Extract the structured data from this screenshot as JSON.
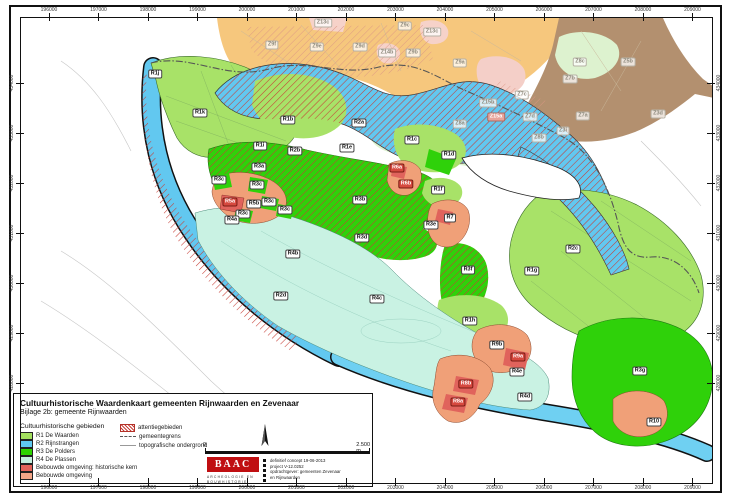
{
  "doc": {
    "title": "Cultuurhistorische Waardenkaart gemeenten Rijnwaarden en Zevenaar",
    "subtitle": "Bijlage 2b: gemeente Rijnwaarden"
  },
  "axes": {
    "x": [
      "196000",
      "197000",
      "198000",
      "199000",
      "200000",
      "201000",
      "202000",
      "203000",
      "204000",
      "205000",
      "206000",
      "207000",
      "208000",
      "209000"
    ],
    "y": [
      "434000",
      "433000",
      "432000",
      "431000",
      "430000",
      "429000",
      "428000"
    ]
  },
  "legend": {
    "areas_header": "Cultuurhistorische gebieden",
    "areas": [
      {
        "label": "R1 De Waarden",
        "color": "#a3e05f"
      },
      {
        "label": "R2 Rijnstrangen",
        "color": "#5fc8f0"
      },
      {
        "label": "R3 De Polders",
        "color": "#2ed400"
      },
      {
        "label": "R4 De Plassen",
        "color": "#c5f0df"
      },
      {
        "label": "Bebouwde omgeving: historische kern",
        "color": "#e4635a"
      },
      {
        "label": "Bebouwde omgeving",
        "color": "#f4a687"
      }
    ],
    "symbols": [
      {
        "label": "attentiegebieden",
        "type": "hatch"
      },
      {
        "label": "gemeentegrens",
        "type": "dashdot"
      },
      {
        "label": "topografische ondergrond",
        "type": "line"
      }
    ]
  },
  "scalebar": {
    "zero": "0",
    "max": "2.500 m"
  },
  "logo": {
    "name": "BAAC",
    "tagline1": "ARCHEOLOGIE EN",
    "tagline2": "BOUWHISTORIE"
  },
  "colophon": {
    "lines": [
      "definitief concept 19-06-2013",
      "project V-12.0252",
      "opdrachtgever: gemeenten Zevenaar",
      "en Rijnwaarden"
    ]
  },
  "colors": {
    "r1": "#a8e268",
    "r2": "#62c8f0",
    "r3": "#2fd10a",
    "r4": "#c9f2e3",
    "kern": "#e0635c",
    "bebouwd": "#f0a078",
    "attention": "#c63d35",
    "zevenaar_orange": "#f6c77d",
    "zevenaar_brown": "#b3906f",
    "zevenaar_pink": "#f6d2c9",
    "zevenaar_green": "#ddf2cf"
  },
  "map_labels": [
    {
      "t": "R1j",
      "x": 155,
      "y": 74,
      "k": "zone"
    },
    {
      "t": "R1k",
      "x": 200,
      "y": 113,
      "k": "zone"
    },
    {
      "t": "R1b",
      "x": 288,
      "y": 120,
      "k": "zone"
    },
    {
      "t": "R2a",
      "x": 359,
      "y": 123,
      "k": "zone"
    },
    {
      "t": "R1i",
      "x": 260,
      "y": 146,
      "k": "zone"
    },
    {
      "t": "R2b",
      "x": 295,
      "y": 151,
      "k": "zone"
    },
    {
      "t": "R1e",
      "x": 347,
      "y": 148,
      "k": "zone"
    },
    {
      "t": "R1c",
      "x": 412,
      "y": 140,
      "k": "zone"
    },
    {
      "t": "R1d",
      "x": 449,
      "y": 155,
      "k": "zone"
    },
    {
      "t": "R1f",
      "x": 438,
      "y": 190,
      "k": "zone"
    },
    {
      "t": "R3a",
      "x": 259,
      "y": 167,
      "k": "zone"
    },
    {
      "t": "R3c",
      "x": 219,
      "y": 180,
      "k": "zone"
    },
    {
      "t": "R3c",
      "x": 257,
      "y": 185,
      "k": "zone"
    },
    {
      "t": "R3b",
      "x": 360,
      "y": 200,
      "k": "zone"
    },
    {
      "t": "R3c",
      "x": 269,
      "y": 202,
      "k": "zone"
    },
    {
      "t": "R5b",
      "x": 254,
      "y": 204,
      "k": "zone"
    },
    {
      "t": "R3c",
      "x": 285,
      "y": 210,
      "k": "zone"
    },
    {
      "t": "R3c",
      "x": 243,
      "y": 214,
      "k": "zone"
    },
    {
      "t": "R4a",
      "x": 232,
      "y": 220,
      "k": "zone"
    },
    {
      "t": "R7",
      "x": 450,
      "y": 218,
      "k": "zone"
    },
    {
      "t": "R3e",
      "x": 431,
      "y": 225,
      "k": "zone"
    },
    {
      "t": "R3d",
      "x": 362,
      "y": 238,
      "k": "zone"
    },
    {
      "t": "R2c",
      "x": 573,
      "y": 249,
      "k": "zone"
    },
    {
      "t": "R4b",
      "x": 293,
      "y": 254,
      "k": "zone"
    },
    {
      "t": "R3f",
      "x": 468,
      "y": 270,
      "k": "zone"
    },
    {
      "t": "R1g",
      "x": 532,
      "y": 271,
      "k": "zone"
    },
    {
      "t": "R2d",
      "x": 281,
      "y": 296,
      "k": "zone"
    },
    {
      "t": "R4c",
      "x": 377,
      "y": 299,
      "k": "zone"
    },
    {
      "t": "R1h",
      "x": 470,
      "y": 321,
      "k": "zone"
    },
    {
      "t": "R9b",
      "x": 497,
      "y": 345,
      "k": "zone"
    },
    {
      "t": "R4e",
      "x": 517,
      "y": 372,
      "k": "zone"
    },
    {
      "t": "R3g",
      "x": 640,
      "y": 371,
      "k": "zone"
    },
    {
      "t": "R4d",
      "x": 525,
      "y": 397,
      "k": "zone"
    },
    {
      "t": "R10",
      "x": 654,
      "y": 422,
      "k": "zone"
    },
    {
      "t": "R5a",
      "x": 230,
      "y": 202,
      "k": "kern"
    },
    {
      "t": "R6a",
      "x": 397,
      "y": 168,
      "k": "kern"
    },
    {
      "t": "R6b",
      "x": 406,
      "y": 184,
      "k": "kern"
    },
    {
      "t": "R9a",
      "x": 518,
      "y": 357,
      "k": "kern"
    },
    {
      "t": "R8b",
      "x": 466,
      "y": 384,
      "k": "kern"
    },
    {
      "t": "R8a",
      "x": 458,
      "y": 402,
      "k": "kern"
    },
    {
      "t": "Z13c",
      "x": 323,
      "y": 23,
      "k": "zev"
    },
    {
      "t": "Z9c",
      "x": 405,
      "y": 26,
      "k": "zev"
    },
    {
      "t": "Z13c",
      "x": 432,
      "y": 32,
      "k": "zev"
    },
    {
      "t": "Z9f",
      "x": 272,
      "y": 45,
      "k": "zev"
    },
    {
      "t": "Z9e",
      "x": 317,
      "y": 47,
      "k": "zev"
    },
    {
      "t": "Z9d",
      "x": 360,
      "y": 47,
      "k": "zev"
    },
    {
      "t": "Z14b",
      "x": 387,
      "y": 53,
      "k": "zev"
    },
    {
      "t": "Z9b",
      "x": 413,
      "y": 53,
      "k": "zev"
    },
    {
      "t": "Z9a",
      "x": 460,
      "y": 63,
      "k": "zev"
    },
    {
      "t": "Z5b",
      "x": 628,
      "y": 62,
      "k": "zev"
    },
    {
      "t": "Z8c",
      "x": 580,
      "y": 62,
      "k": "zev"
    },
    {
      "t": "Z7b",
      "x": 570,
      "y": 79,
      "k": "zev"
    },
    {
      "t": "Z7c",
      "x": 522,
      "y": 95,
      "k": "zev"
    },
    {
      "t": "Z15b",
      "x": 488,
      "y": 103,
      "k": "zev"
    },
    {
      "t": "Z7a",
      "x": 583,
      "y": 116,
      "k": "zev"
    },
    {
      "t": "Z7d",
      "x": 530,
      "y": 117,
      "k": "zev"
    },
    {
      "t": "Z3d",
      "x": 658,
      "y": 114,
      "k": "zev"
    },
    {
      "t": "Z8a",
      "x": 460,
      "y": 124,
      "k": "zev"
    },
    {
      "t": "Z3i",
      "x": 563,
      "y": 131,
      "k": "zev"
    },
    {
      "t": "Z8b",
      "x": 539,
      "y": 138,
      "k": "zev"
    },
    {
      "t": "Z15a",
      "x": 496,
      "y": 117,
      "k": "zevkern"
    }
  ]
}
